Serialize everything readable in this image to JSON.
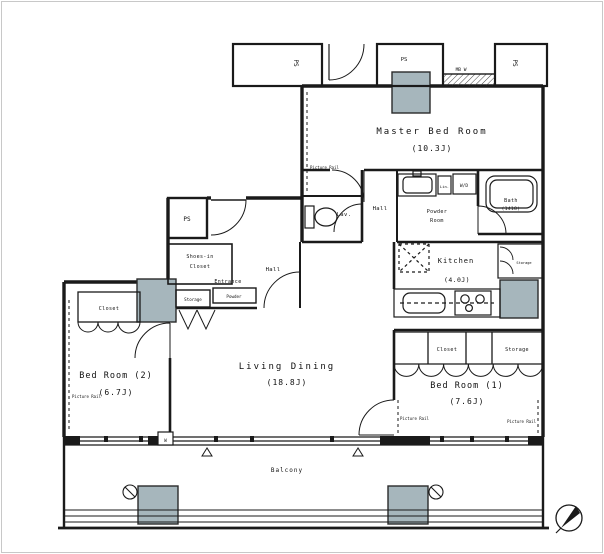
{
  "rooms": {
    "master_bedroom": {
      "name": "Master Bed Room",
      "size": "(10.3J)"
    },
    "bedroom_1": {
      "name": "Bed Room (1)",
      "size": "(7.6J)"
    },
    "bedroom_2": {
      "name": "Bed Room (2)",
      "size": "(6.7J)"
    },
    "living_dining": {
      "name": "Living Dining",
      "size": "(18.8J)"
    },
    "kitchen": {
      "name": "Kitchen",
      "size": "(4.0J)"
    },
    "bath": {
      "name": "Bath",
      "size": "(1418)"
    },
    "powder_room": {
      "name_line1": "Powder",
      "name_line2": "Room"
    },
    "hall": "Hall",
    "entry_hall": "Hall",
    "lavatory": "Lav.",
    "entrance": "Entrance",
    "shoes_in_closet": {
      "name_line1": "Shoes-in",
      "name_line2": "Closet"
    },
    "balcony": "Balcony"
  },
  "storage": {
    "bedroom_2_closet": "Closet",
    "bedroom_1_closet": "Closet",
    "bedroom_1_storage": "Storage",
    "entrance_storage": "Storage",
    "entrance_powder_cabinet": "Powder",
    "kitchen_storage": "Storage",
    "linen": "Lin.",
    "washer_dryer": "W/D"
  },
  "annotations": {
    "pipe_space": "PS",
    "meter_box": "MB W",
    "picture_rail": "Picture Rail",
    "window_mark": "W"
  },
  "colors": {
    "line": "#1a1a1a",
    "column_fill": "#a6b6bc"
  }
}
